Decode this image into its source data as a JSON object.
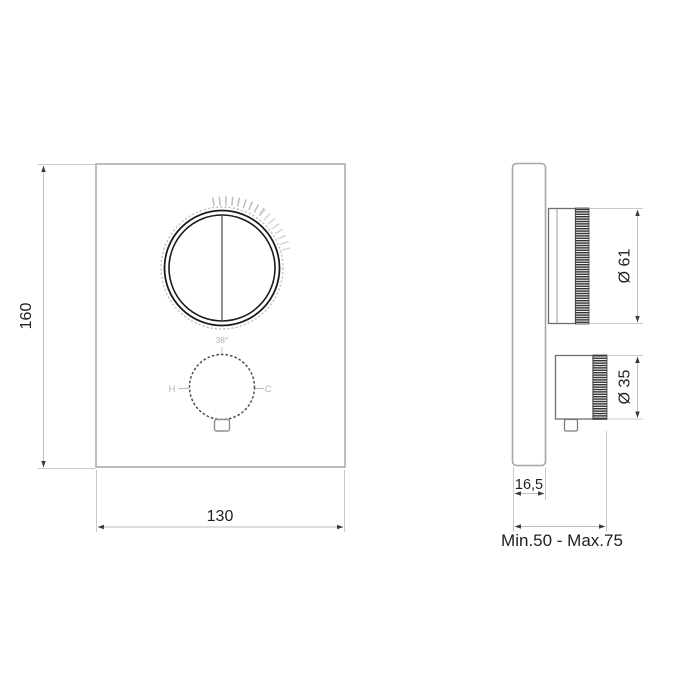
{
  "front_view": {
    "height_dim": "160",
    "width_dim": "130",
    "temp_label": "38°",
    "hot_label": "H",
    "cold_label": "C"
  },
  "side_view": {
    "plate_depth_dim": "16,5",
    "large_knob_diameter": "Ø 61",
    "small_knob_diameter": "Ø 35",
    "installation_depth_label": "Min.50 - Max.75"
  },
  "colors": {
    "outline_dark": "#2d2d2d",
    "outline_medium": "#8a8a8a",
    "outline_light": "#c6c6c6",
    "dimension_text": "#1f1f1f",
    "background": "#ffffff"
  }
}
